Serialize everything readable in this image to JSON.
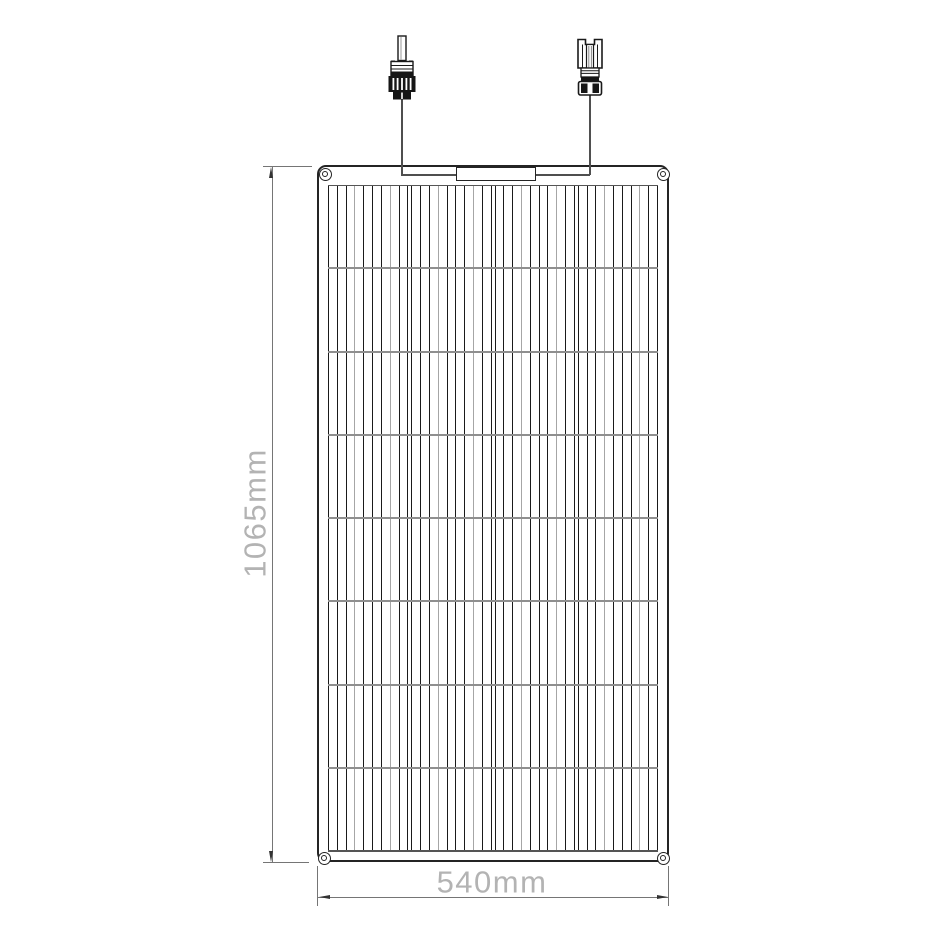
{
  "drawing": {
    "subject": "Flexible solar panel dimensional line drawing",
    "height_dimension": "1065mm",
    "width_dimension": "540mm"
  },
  "panel": {
    "grid": {
      "rows": 8,
      "column_groups": 4,
      "cells_per_group": 9,
      "gray_cell_indices": [
        2,
        6
      ]
    },
    "eyelets": [
      "top-left",
      "top-right",
      "bottom-left",
      "bottom-right"
    ],
    "junction_box": "junction-box"
  },
  "connectors": {
    "left": "MC4 male connector",
    "right": "MC4 female connector"
  },
  "colors": {
    "ink": "#242424",
    "cell_line": "#1a1a1a",
    "cell_line_gray": "#a6a6a6",
    "row_divider": "#8f8f8f",
    "grid_edge": "#555555",
    "wire": "#4f4f4f",
    "dimension_line": "#757575",
    "dimension_arrow": "#333333",
    "dimension_text": "#b3b3b3",
    "background": "#ffffff"
  }
}
